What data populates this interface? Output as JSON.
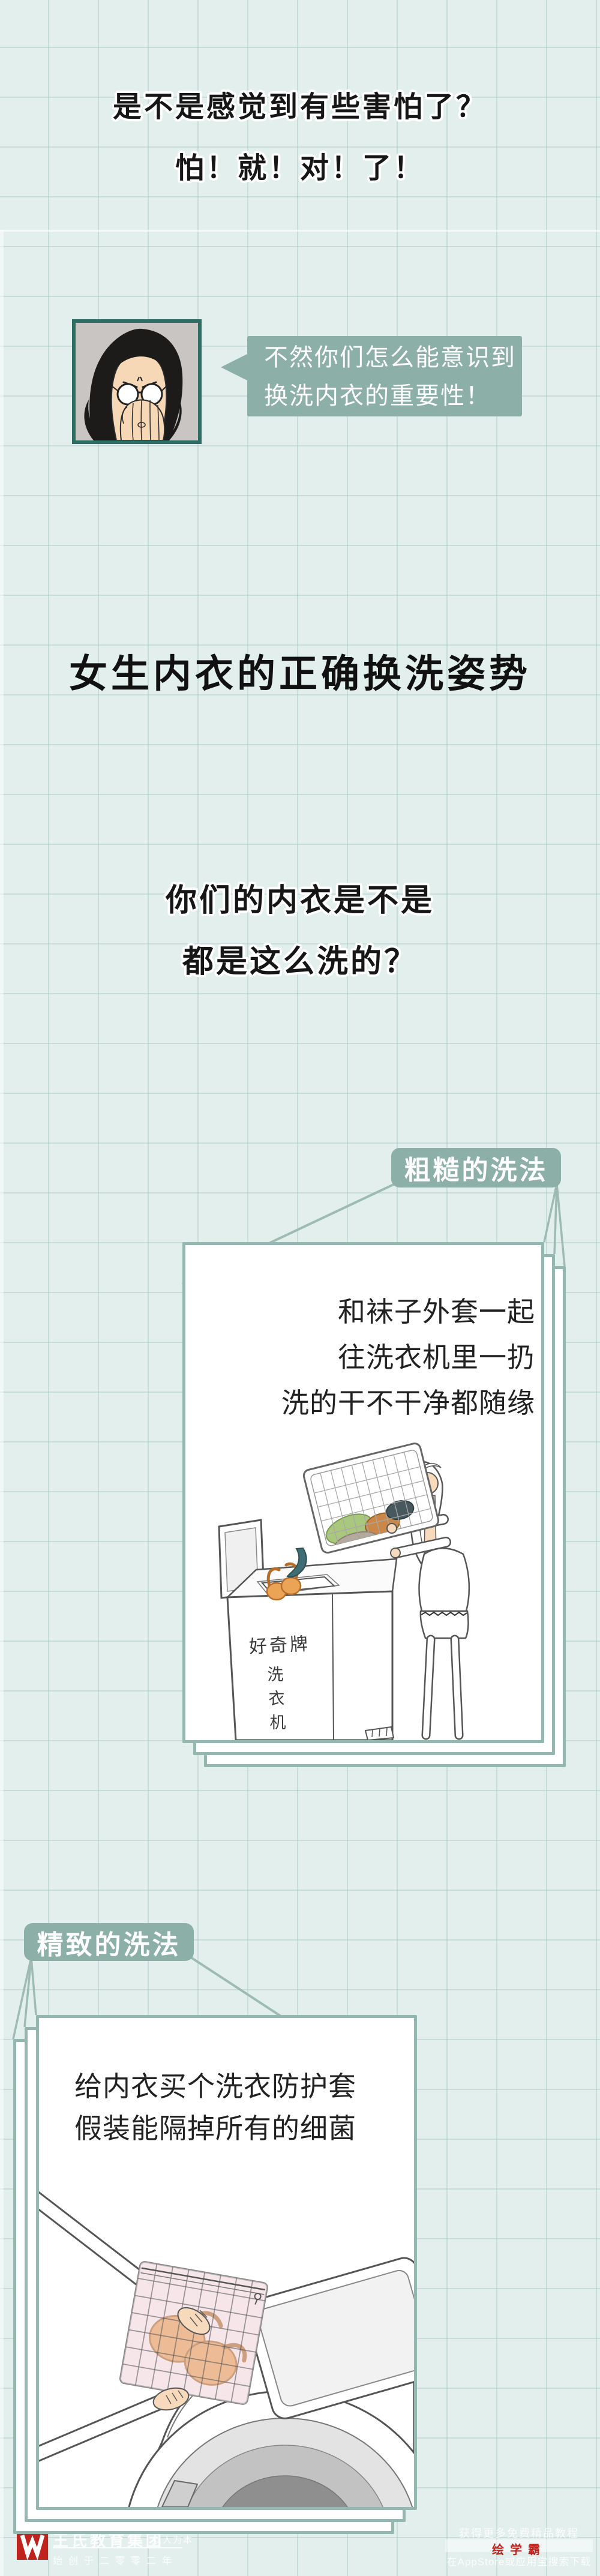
{
  "colors": {
    "background": "#e3efec",
    "sage": "#8cb0a8",
    "panel_border": "#96b7af",
    "string": "#9dbbb3",
    "accent_red": "#c0231e",
    "text_black": "#161616"
  },
  "intro": {
    "line1": "是不是感觉到有些害怕了？",
    "line2": "怕！就！对！了！"
  },
  "narrator": {
    "bubble_line1": "不然你们怎么能意识到",
    "bubble_line2": "换洗内衣的重要性！"
  },
  "title": "女生内衣的正确换洗姿势",
  "question": {
    "line1": "你们的内衣是不是",
    "line2": "都是这么洗的？"
  },
  "rough_section": {
    "tag": "粗糙的洗法",
    "line1": "和袜子外套一起",
    "line2": "往洗衣机里一扔",
    "line3": "洗的干不干净都随缘",
    "machine_brand": "好奇牌",
    "machine_label_char1": "洗",
    "machine_label_char2": "衣",
    "machine_label_char3": "机"
  },
  "fine_section": {
    "tag": "精致的洗法",
    "line1": "给内衣买个洗衣防护套",
    "line2": "假装能隔掉所有的细菌"
  },
  "footer_left": {
    "org": "王氏教育集团",
    "slogan": "以人为本",
    "since": "始创于二零零二年"
  },
  "footer_right": {
    "promo": "获得更多免费精品教程",
    "brand": "绘学霸",
    "download": "在AppStore或应用宝搜索下载"
  }
}
